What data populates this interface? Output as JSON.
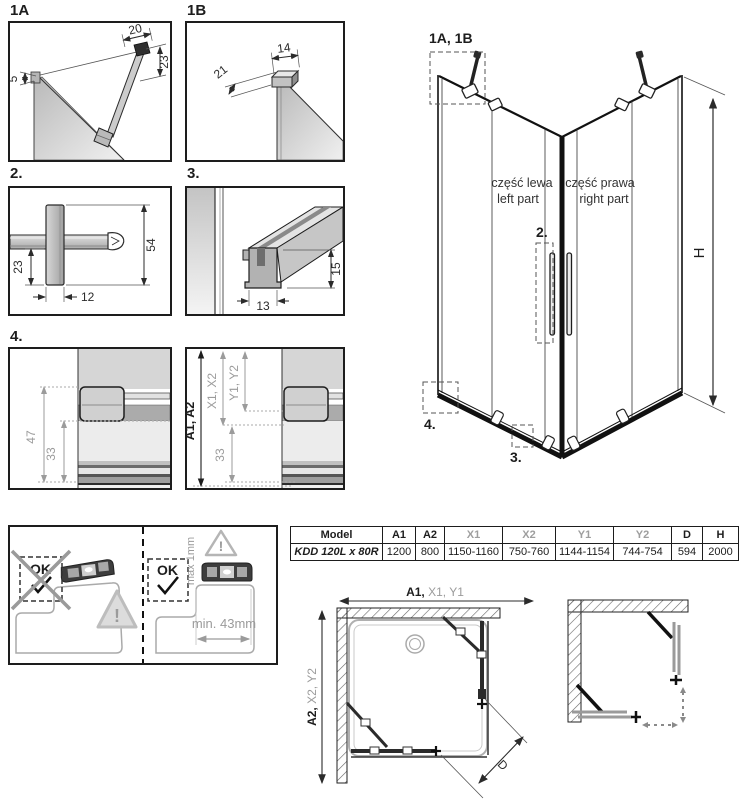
{
  "detail_1a": {
    "label": "1A",
    "dim_width": "20",
    "dim_height": "23",
    "dim_offset": "5"
  },
  "detail_1b": {
    "label": "1B",
    "dim_width": "14",
    "dim_depth": "21"
  },
  "detail_2": {
    "label": "2.",
    "dim_length": "54",
    "dim_offset": "23",
    "dim_width": "12"
  },
  "detail_3": {
    "label": "3.",
    "dim_height": "15",
    "dim_width": "13"
  },
  "detail_4": {
    "label": "4.",
    "dim_47": "47",
    "dim_33": "33",
    "dim_a": "A1, A2",
    "dim_x": "X1, X2",
    "dim_y": "Y1, Y2",
    "dim_33b": "33"
  },
  "isometric": {
    "ref_1ab": "1A, 1B",
    "ref_2": "2.",
    "ref_3": "3.",
    "ref_4": "4.",
    "dim_h": "H",
    "part_left_pl": "część lewa",
    "part_left_en": "left part",
    "part_right_pl": "część prawa",
    "part_right_en": "right part"
  },
  "leveling": {
    "ok_bad": "OK",
    "ok_good": "OK",
    "warn_bad": "!",
    "warn_good": "!",
    "max_gap": "max 1mm",
    "min_width": "min. 43mm"
  },
  "spec_table": {
    "headers": [
      "Model",
      "A1",
      "A2",
      "X1",
      "X2",
      "Y1",
      "Y2",
      "D",
      "H"
    ],
    "row": [
      "KDD 120L x 80R",
      "1200",
      "800",
      "1150-1160",
      "750-760",
      "1144-1154",
      "744-754",
      "594",
      "2000"
    ]
  },
  "plan": {
    "dim_top_a": "A1,",
    "dim_top_xy": " X1, Y1",
    "dim_left_a": "A2,",
    "dim_left_xy": " X2, Y2",
    "dim_d": "D"
  },
  "colors": {
    "line": "#1d1d1d",
    "dim_gray": "#9b9b9b"
  }
}
